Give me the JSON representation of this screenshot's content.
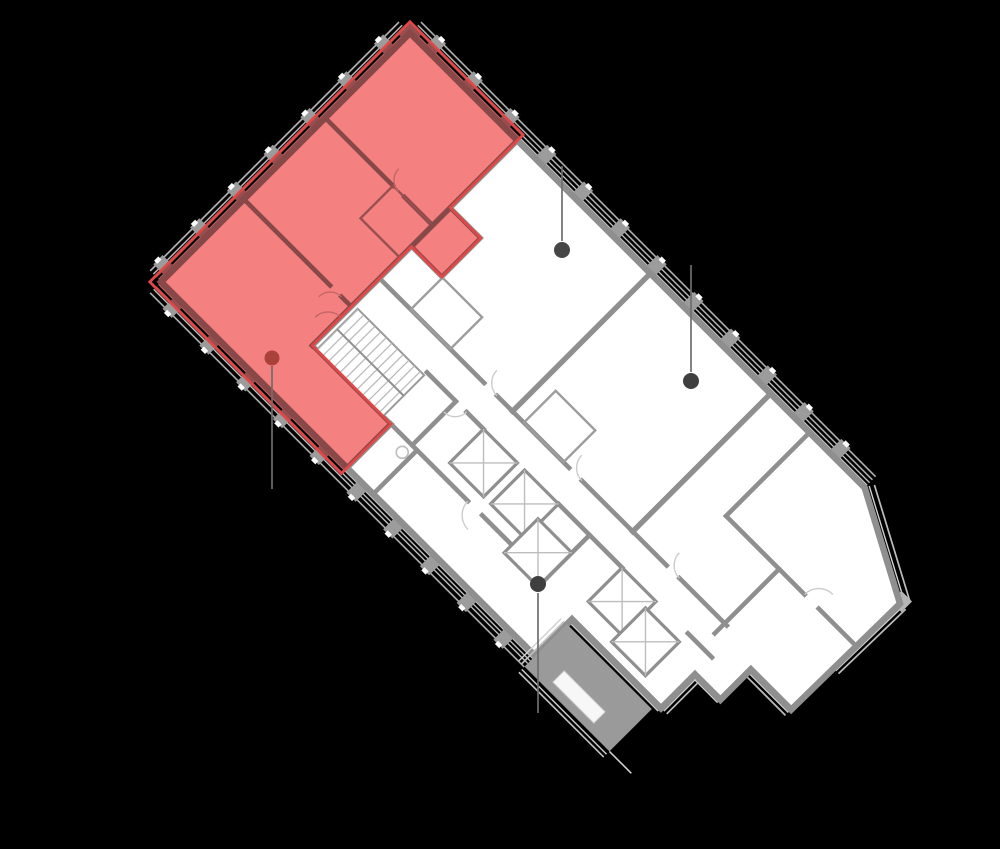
{
  "scene": {
    "type": "floor-plan-viewer",
    "background": "#000000",
    "width": 1000,
    "height": 849,
    "visible_text": "none"
  },
  "floor_plan": {
    "rotation_deg": 45,
    "origin": {
      "x": 410,
      "y": 33
    },
    "colors": {
      "building_fill": "#ffffff",
      "wall": "#8f8f8f",
      "pier": "#9c9c9c",
      "facade_line": "#d6d6d6",
      "terrace_fill": "#9a9a9a",
      "selected_fill": "#f58080",
      "selected_border": "#e04848",
      "leader_line": "#6e6e6e"
    },
    "features": [
      "stairs",
      "elevator-shafts",
      "balcony-facade",
      "terrace-roof"
    ]
  },
  "selected_unit": {
    "highlighted": true,
    "fill": "#f58080",
    "border": "#e04848"
  },
  "unit_markers": [
    {
      "id": "marker-selected-unit",
      "x": 272,
      "y": 358,
      "r": 7.5,
      "color": "#a8423b",
      "line_y1": 366,
      "line_y2": 489,
      "selected": true
    },
    {
      "id": "marker-unit-2",
      "x": 562,
      "y": 250,
      "r": 8,
      "color": "#464646",
      "line_y1": 166,
      "line_y2": 241,
      "selected": false
    },
    {
      "id": "marker-unit-3",
      "x": 691,
      "y": 381,
      "r": 8,
      "color": "#3f3f3f",
      "line_y1": 265,
      "line_y2": 372,
      "selected": false
    },
    {
      "id": "marker-unit-4",
      "x": 538,
      "y": 584,
      "r": 8,
      "color": "#3f3f3f",
      "line_y1": 593,
      "line_y2": 713,
      "selected": false
    }
  ]
}
